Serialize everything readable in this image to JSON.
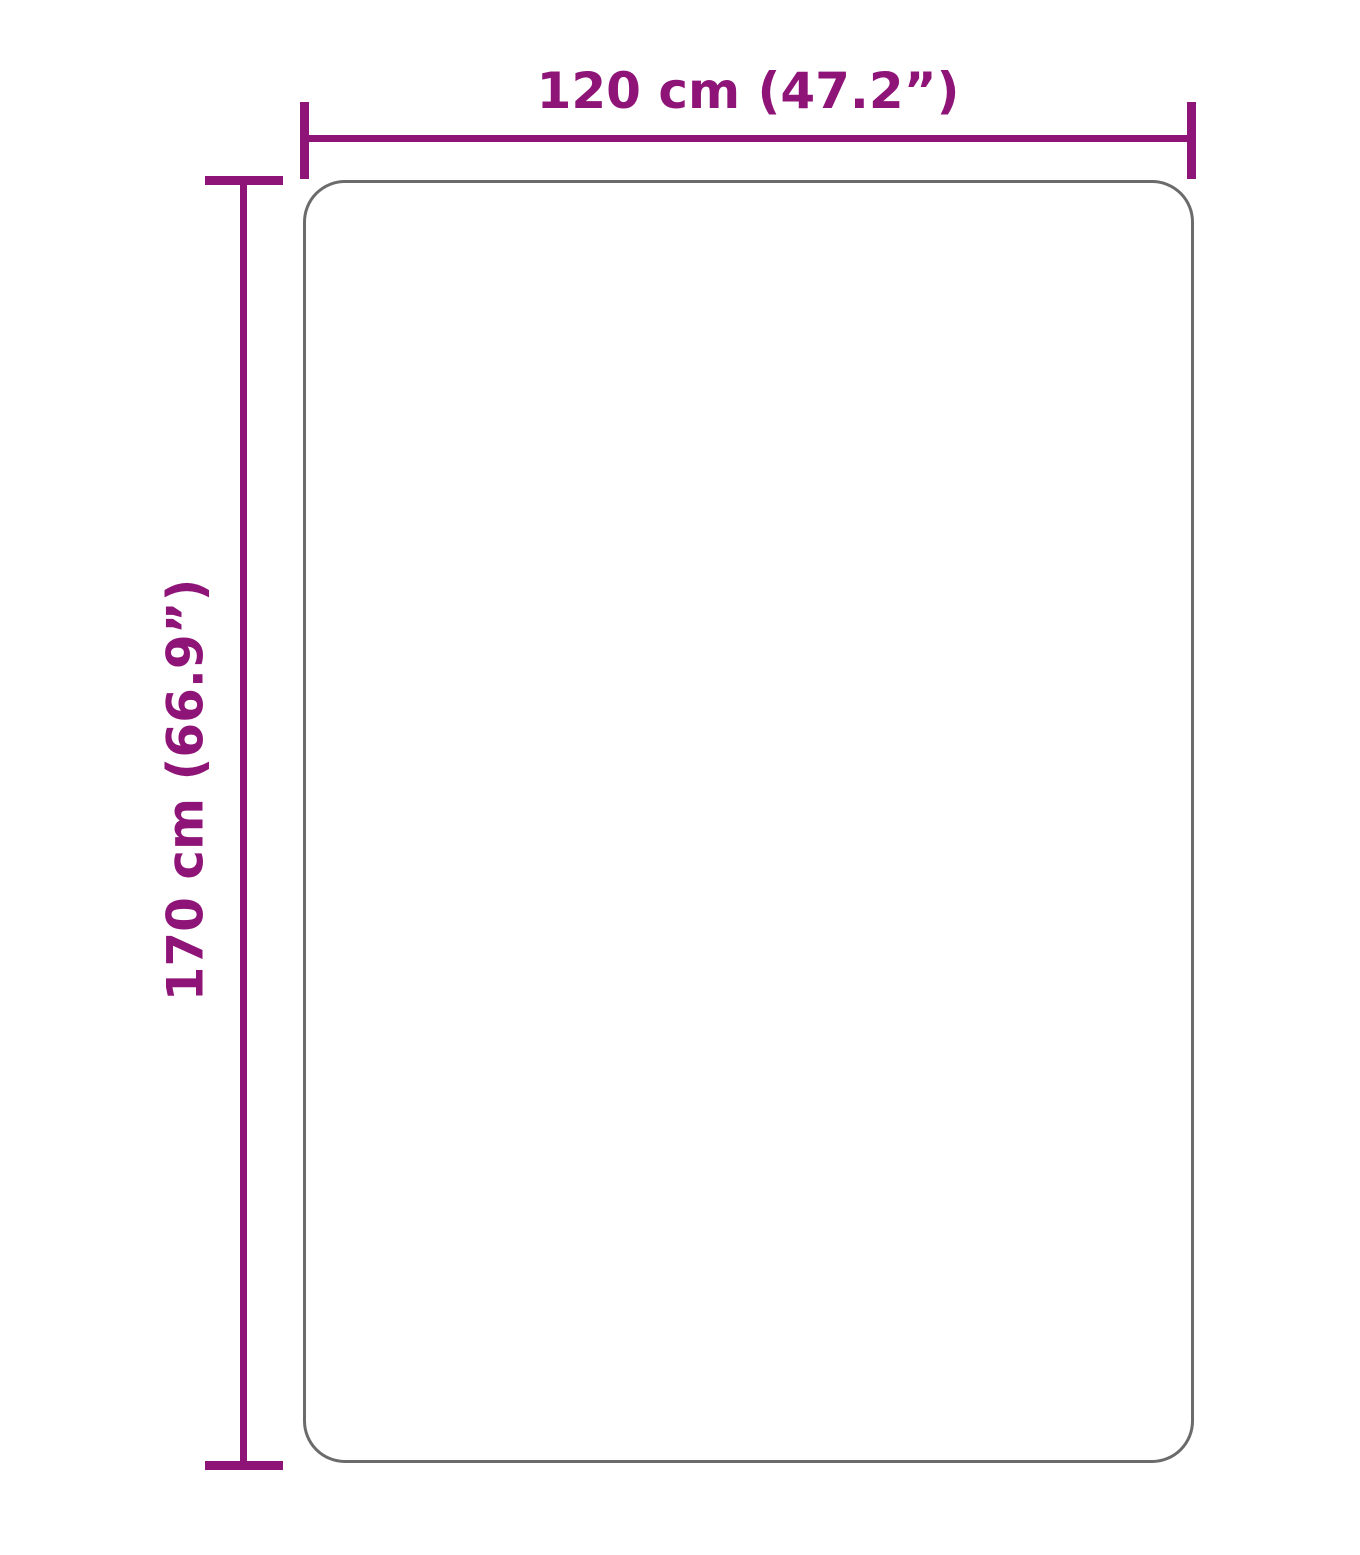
{
  "diagram": {
    "kind": "product-dimension-diagram",
    "width_dimension": {
      "label": "120 cm (47.2”)",
      "value_cm": 120,
      "value_inches": 47.2
    },
    "height_dimension": {
      "label": "170 cm (66.9”)",
      "value_cm": 170,
      "value_inches": 66.9
    },
    "colors": {
      "dimension_accent": "#8F1478",
      "outline_gray": "#6B6B6B",
      "background": "#FFFFFF"
    }
  }
}
